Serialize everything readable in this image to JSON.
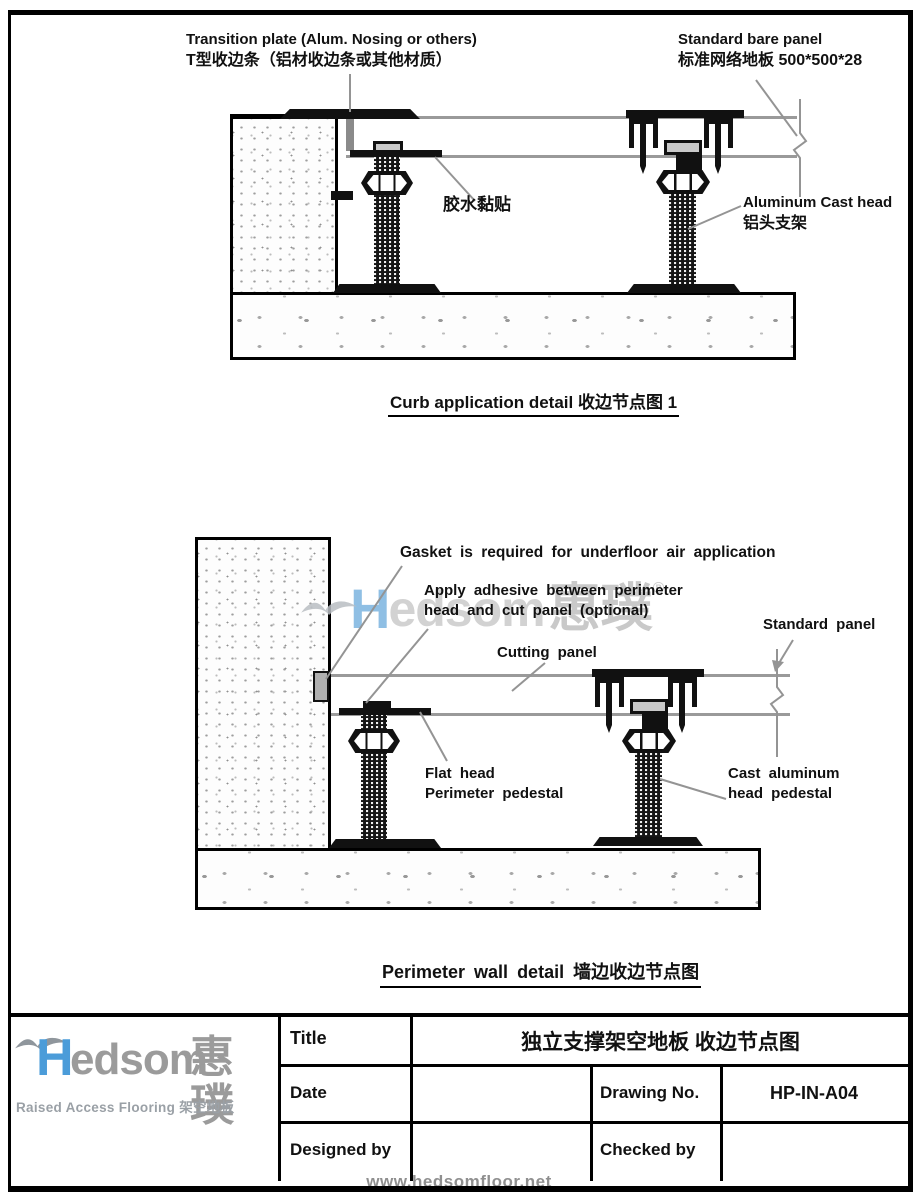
{
  "colors": {
    "logo_blue": "#4b9cd9",
    "logo_gray": "#9b9b9b",
    "line_gray": "#9a9a9a",
    "watermark_gray": "#c9c9c9"
  },
  "drawing1": {
    "caption": "Curb application detail 收边节点图 1",
    "labels": {
      "transition_en": "Transition plate (Alum. Nosing or others)",
      "transition_zh": "T型收边条（铝材收边条或其他材质）",
      "panel_en": "Standard bare panel",
      "panel_zh": "标准网络地板 500*500*28",
      "glue_zh": "胶水黏贴",
      "cast_head_en": "Aluminum Cast head",
      "cast_head_zh": "铝头支架"
    }
  },
  "drawing2": {
    "caption": "Perimeter wall detail 墙边收边节点图",
    "watermark": {
      "brand_h": "H",
      "brand_body": "edsom",
      "brand_cjk": "惠璞",
      "reg": "®"
    },
    "labels": {
      "gasket": "Gasket is required for underfloor air application",
      "adhesive_1": "Apply adhesive between perimeter",
      "adhesive_2": "head and cut panel (optional)",
      "cutting_panel": "Cutting panel",
      "standard_panel": "Standard panel",
      "flat_head_1": "Flat head",
      "flat_head_2": "Perimeter pedestal",
      "cast_head_1": "Cast aluminum",
      "cast_head_2": "head pedestal"
    }
  },
  "title_block": {
    "logo": {
      "brand_h": "H",
      "brand_body": "edsom",
      "brand_cjk": "惠璞",
      "tagline": "Raised Access Flooring 架空地板"
    },
    "title_label": "Title",
    "title_value": "独立支撑架空地板 收边节点图",
    "date_label": "Date",
    "drawing_no_label": "Drawing No.",
    "drawing_no_value": "HP-IN-A04",
    "designed_by_label": "Designed by",
    "checked_by_label": "Checked by"
  },
  "footer": {
    "url": "www.hedsomfloor.net"
  }
}
